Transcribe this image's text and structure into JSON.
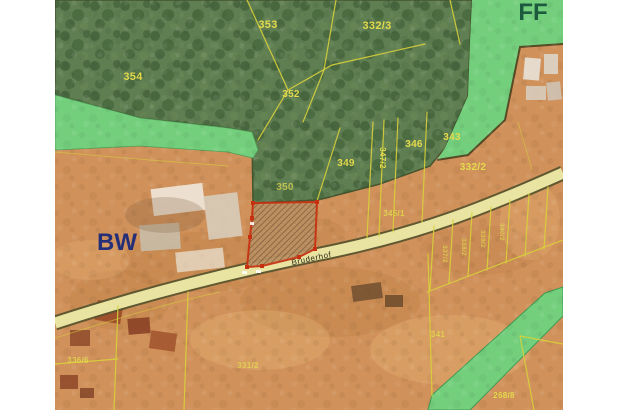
{
  "map": {
    "type": "cadastral-aerial-overlay",
    "regions": {
      "ff_label": "FF",
      "bw_label": "BW"
    },
    "road": {
      "name": "Bruderhof"
    },
    "selected_parcel": {
      "style": "hatched",
      "outline_color": "#c62f10"
    },
    "parcel_labels": {
      "p353": "353",
      "p354": "354",
      "p352": "352",
      "p332_3": "332/3",
      "p349": "349",
      "p347_2": "347/2",
      "p346": "346",
      "p343": "343",
      "p350": "350",
      "p332_2": "332/2",
      "p345_1": "345/1",
      "p341": "341",
      "p336_6": "336/6",
      "p331_2": "331/2",
      "p268_8": "268/8",
      "strip_1": "337/2",
      "strip_2": "338/2",
      "strip_3": "339/2",
      "strip_4": "340/2"
    },
    "colors": {
      "forest": "#5f7e51",
      "forest_dark": "#41603b",
      "meadow": "#74cf7d",
      "ground": "#d0915a",
      "ground_dark": "#b5793e",
      "ground_light": "#e7b678",
      "parcel_line": "#d8d23a",
      "label_text": "#e3da4d",
      "selection": "#c62f10",
      "road_fill": "#e9e4a2",
      "road_casing": "#54522d",
      "boundary_dark": "#46542f",
      "ff_text": "#1d5b3f",
      "bw_text": "#252f78"
    }
  }
}
